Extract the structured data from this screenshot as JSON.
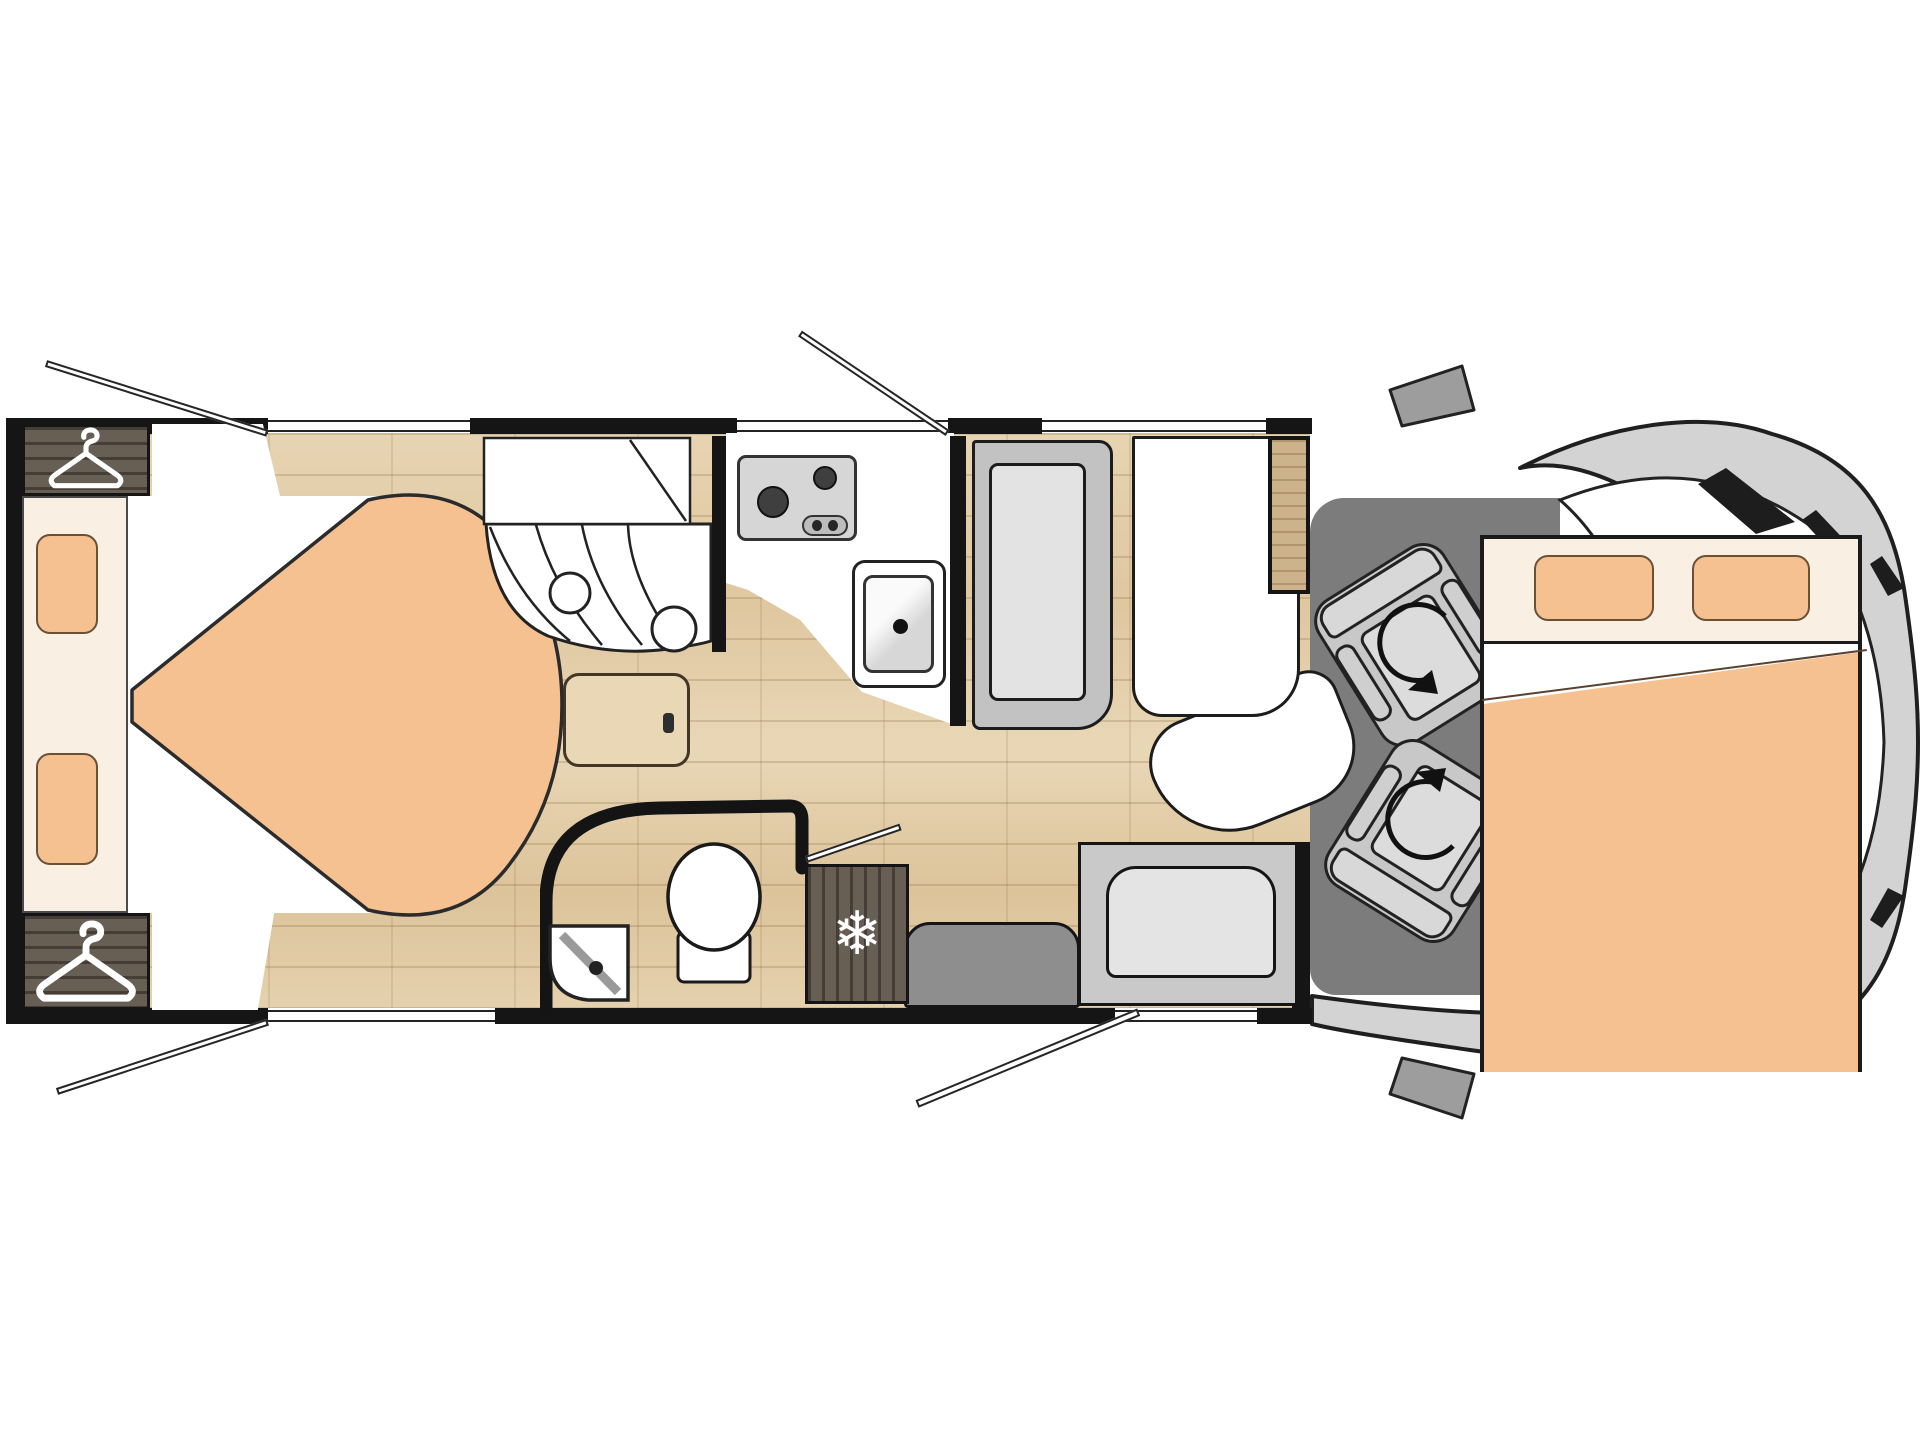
{
  "title": "motorhome-floor-plan",
  "palette": {
    "wall": "#151515",
    "line": "#222222",
    "floor": "#e2cda9",
    "wood_dark": "#5f554b",
    "wood_light": "#cdb38c",
    "cream": "#f9efe3",
    "peach": "#f5c191",
    "white": "#ffffff",
    "bench": "#c2c2c2",
    "cushion": "#e3e3e3",
    "cab_floor": "#7c7c7c",
    "cab_body": "#d3d3d3",
    "seat": "#c8c8c8",
    "entry_seat": "#8e8e8e"
  },
  "icons": {
    "snowflake_glyph": "❄",
    "hanger": "hanger-icon",
    "rotation_arrow": "swivel-arrow-icon"
  },
  "rooms": {
    "rear_bedroom": {
      "features": [
        "wardrobe",
        "wardrobe",
        "headboard",
        "two-pillows",
        "island-bed",
        "floor-hatch"
      ]
    },
    "shower_room": {
      "features": [
        "shelf",
        "curtain",
        "shower-heads"
      ]
    },
    "kitchen": {
      "features": [
        "hob-two-burners",
        "controls",
        "sink",
        "faucet"
      ]
    },
    "bathroom": {
      "features": [
        "toilet",
        "corner-basin",
        "door"
      ]
    },
    "galley": {
      "features": [
        "fridge-freezer"
      ]
    },
    "dinette": {
      "features": [
        "bench-seat",
        "table",
        "side-seat",
        "entrance-seat",
        "entrance-step"
      ]
    },
    "cab": {
      "features": [
        "swivel-seat",
        "swivel-seat",
        "drop-down-bed",
        "windshield",
        "mirrors"
      ]
    }
  },
  "openings": {
    "windows_top": 3,
    "windows_bottom": 1,
    "open_panes": 3,
    "entry_door": 1,
    "bathroom_door": 1
  }
}
